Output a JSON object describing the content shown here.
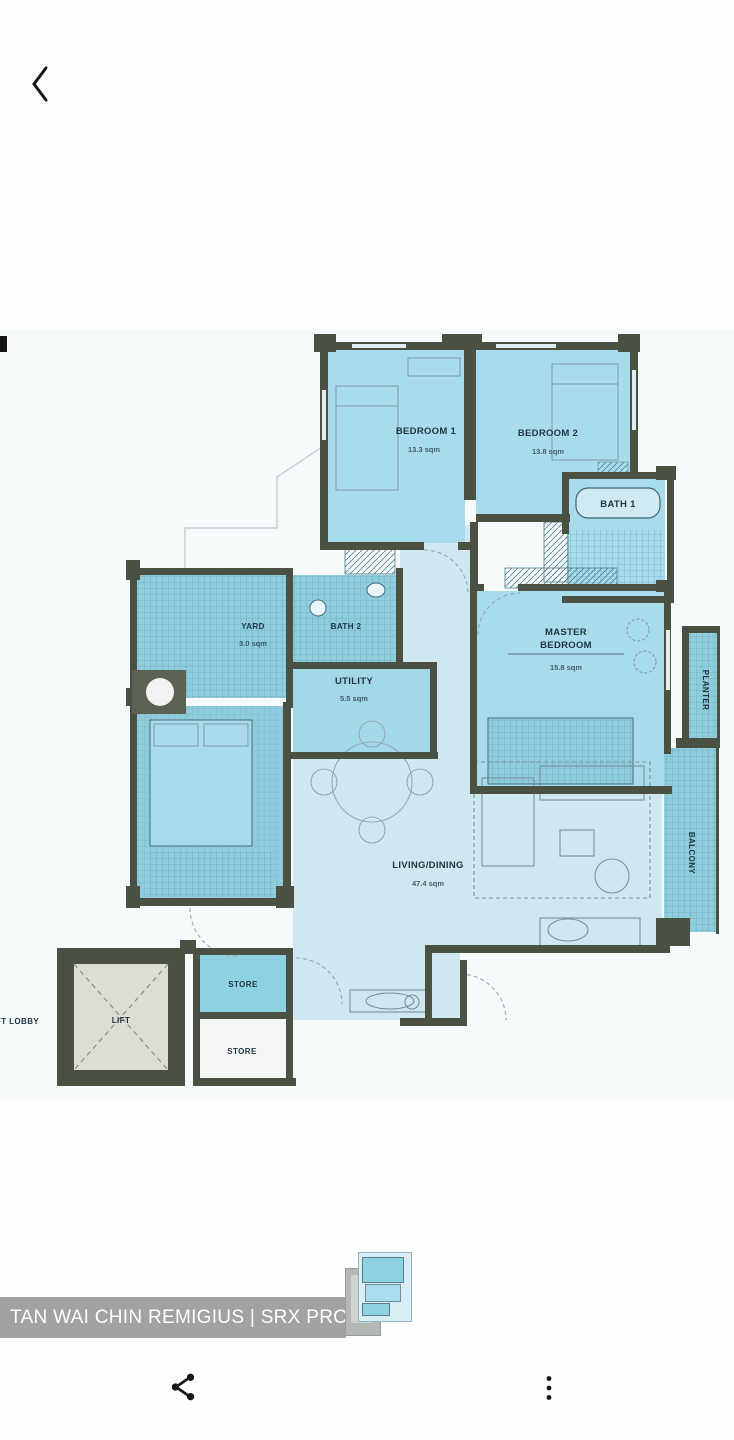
{
  "header": {
    "back_icon": "chevron-left"
  },
  "floor_plan": {
    "bedroom1": {
      "name": "BEDROOM 1",
      "area": "13.3 sqm"
    },
    "bedroom2": {
      "name": "BEDROOM 2",
      "area": "13.8 sqm"
    },
    "bath1": {
      "name": "BATH 1"
    },
    "bath2": {
      "name": "BATH 2"
    },
    "yard": {
      "name": "YARD",
      "area": "3.0 sqm"
    },
    "utility": {
      "name": "UTILITY",
      "area": "5.5 sqm"
    },
    "master_bedroom": {
      "lines": [
        "MASTER",
        "BEDROOM"
      ],
      "area": "15.8 sqm"
    },
    "living_dining": {
      "name": "LIVING/DINING",
      "area": "47.4 sqm"
    },
    "planter": {
      "name": "PLANTER"
    },
    "balcony": {
      "name": "BALCONY"
    },
    "store_upper": {
      "name": "STORE"
    },
    "store_lower": {
      "name": "STORE"
    },
    "lift": {
      "name": "LIFT"
    },
    "lift_lobby": {
      "name": "LIFT LOBBY"
    }
  },
  "watermark": {
    "text": "TAN WAI CHIN REMIGIUS | SRX PROPERTY"
  },
  "footer": {
    "share_icon": "share-icon",
    "more_icon": "more-vertical-icon"
  },
  "colors": {
    "wall": "#4a5042",
    "room_fill": "#a8dcec",
    "tiled_fill": "#8fccdc",
    "floor_pale": "#cfe7f1",
    "lift_fill": "#dcded4",
    "label": "#1f3340",
    "watermark_bg": "#8d8d8d",
    "watermark_text": "#ffffff",
    "icon": "#1a1a1a"
  }
}
